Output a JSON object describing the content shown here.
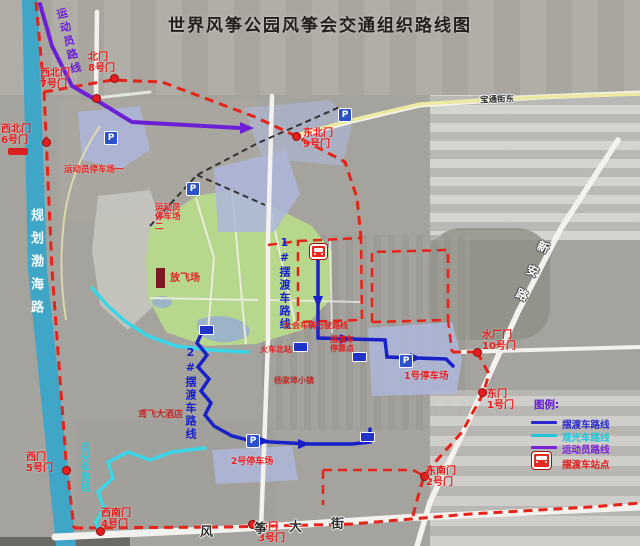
{
  "title": "世界风筝公园风筝会交通组织路线图",
  "gates": [
    {
      "name": "北门",
      "num": "8号门"
    },
    {
      "name": "西北门",
      "num": "7号门"
    },
    {
      "name": "西北门",
      "num": "6号门"
    },
    {
      "name": "东北门",
      "num": "9号门"
    },
    {
      "name": "水厂门",
      "num": "10号门"
    },
    {
      "name": "东门",
      "num": "1号门"
    },
    {
      "name": "东南门",
      "num": "2号门"
    },
    {
      "name": "南门",
      "num": "3号门"
    },
    {
      "name": "西南门",
      "num": "4号门"
    },
    {
      "name": "西门",
      "num": "5号门"
    }
  ],
  "parking": {
    "athlete1": "运动员停车场一",
    "athlete2": "运动员停车场二",
    "p1": "1号停车场",
    "p2": "2号停车场"
  },
  "venues": {
    "flying_field": "放飞场"
  },
  "roads": {
    "bohai": "规划渤海路",
    "xinan": "新安路",
    "fengzheng_chars": [
      "风",
      "筝",
      "大",
      "街"
    ],
    "northeast_street": "宝通街东"
  },
  "route_labels": {
    "athlete": "运动员路线",
    "shuttle1": "1#摆渡车路线",
    "shuttle2": "2#摆渡车路线",
    "sightseeing": "观光车路线"
  },
  "pois": {
    "social_route": "社会车辆行驶路线",
    "rail_station": "火车北站",
    "stop_line1": "摆渡车",
    "stop_line2": "停靠点",
    "town": "杨家埠小镇",
    "hotel": "鸢飞大酒店"
  },
  "legend": {
    "title": "图例:",
    "items": [
      {
        "label": "摆渡车路线",
        "color": "#2a2ad0"
      },
      {
        "label": "观光车路线",
        "color": "#22c4d8"
      },
      {
        "label": "运动员路线",
        "color": "#7a22d8"
      },
      {
        "label": "摆渡车站点",
        "color": "#e02020"
      }
    ]
  },
  "icons": {
    "parking_letter": "P"
  },
  "colors": {
    "shuttle_route": "#1822c8",
    "sightseeing_route": "#38d6e6",
    "athlete_route": "#6d1fd6",
    "control_boundary": "#e62319",
    "planned_road": "#3fa6c8"
  }
}
